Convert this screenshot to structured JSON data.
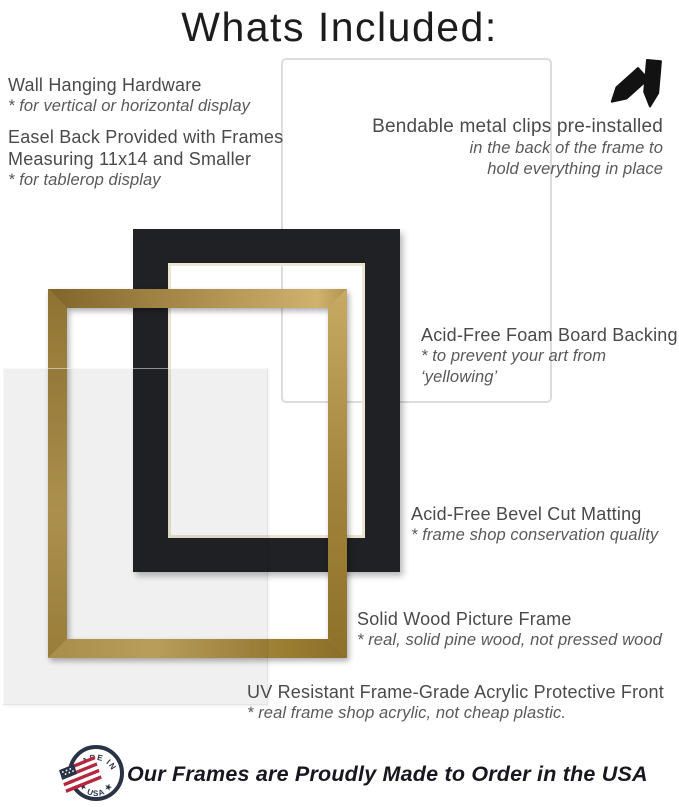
{
  "title": "Whats Included:",
  "annotations": {
    "wall_hanging": {
      "heading": "Wall Hanging Hardware",
      "note": "* for vertical or horizontal display"
    },
    "easel_back": {
      "heading_lines": [
        "Easel Back Provided with Frames",
        "Measuring 11x14 and Smaller"
      ],
      "note": "* for tablerop display"
    },
    "metal_clips": {
      "heading": "Bendable metal clips pre-installed",
      "note_lines": [
        "in the back of the frame to",
        "hold everything in place"
      ]
    },
    "foam_board": {
      "heading": "Acid-Free Foam Board Backing",
      "note": "* to prevent your art from ‘yellowing’"
    },
    "matting": {
      "heading": "Acid-Free Bevel Cut Matting",
      "note": "* frame shop conservation quality"
    },
    "wood_frame": {
      "heading": "Solid Wood Picture Frame",
      "note": "* real, solid pine wood, not pressed wood"
    },
    "acrylic_front": {
      "heading": "UV Resistant Frame-Grade Acrylic Protective Front",
      "note": "* real frame shop acrylic, not cheap plastic."
    }
  },
  "footer": {
    "badge": {
      "top_text": "★ MADE IN ★",
      "bottom_text": "★ USA ★"
    },
    "tagline": "Our Frames are Proudly Made to Order in the USA"
  },
  "icons": {
    "clips": "bendable-metal-clips-icon",
    "badge": "made-in-usa-badge-icon"
  },
  "colors": {
    "gold_frame": "#b2914a",
    "mat_black": "#202124",
    "mat_bevel_ivory": "#ede5d2",
    "foam_board_border": "#dcdcdc",
    "badge_navy": "#2a3248",
    "flag_red": "#b5273c",
    "heading_grey": "#4a4a4a",
    "note_grey": "#595959",
    "title_black": "#1c1c1c"
  }
}
